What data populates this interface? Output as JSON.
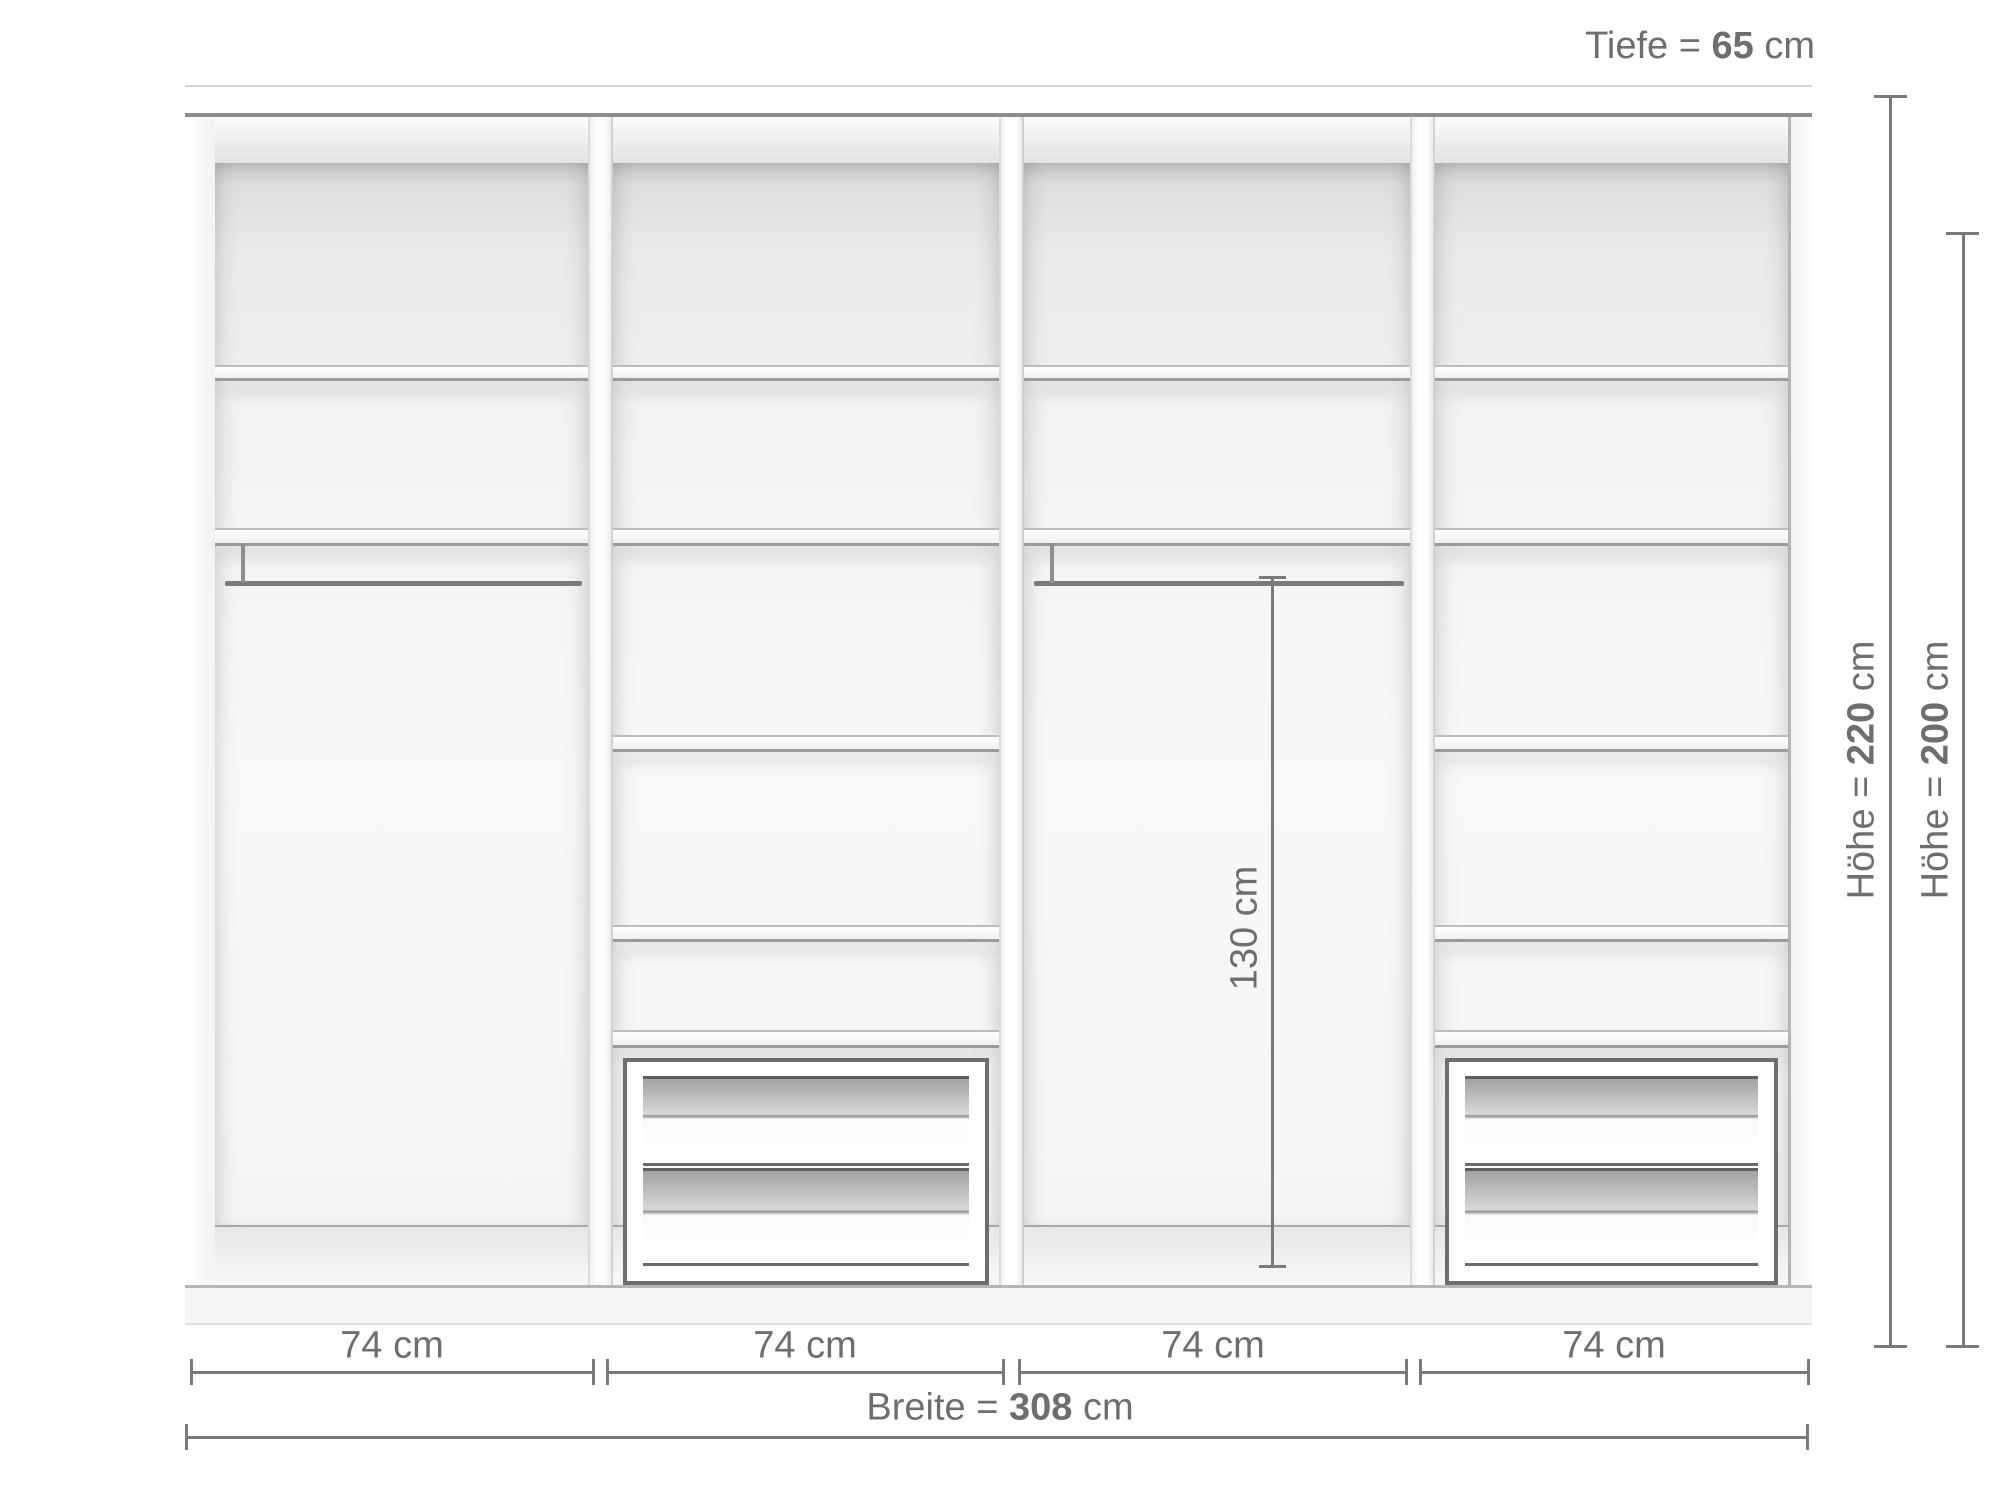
{
  "colors": {
    "dimension_text": "#6e6e6e",
    "dimension_line": "#7a7a7a"
  },
  "annotations": {
    "depth": {
      "prefix": "Tiefe = ",
      "value": "65",
      "unit": " cm"
    },
    "outer_height": {
      "prefix": "Höhe = ",
      "value": "220",
      "unit": " cm"
    },
    "inner_height": {
      "prefix": "Höhe = ",
      "value": "200",
      "unit": " cm"
    },
    "rail_height": "130 cm",
    "total_width": {
      "prefix": "Breite = ",
      "value": "308",
      "unit": " cm"
    }
  },
  "wardrobe": {
    "sections": [
      {
        "width_label": "74 cm",
        "shelves": 2,
        "clothes_rail": true,
        "drawers": 0
      },
      {
        "width_label": "74 cm",
        "shelves": 5,
        "clothes_rail": false,
        "drawers": 2
      },
      {
        "width_label": "74 cm",
        "shelves": 2,
        "clothes_rail": true,
        "drawers": 0
      },
      {
        "width_label": "74 cm",
        "shelves": 5,
        "clothes_rail": false,
        "drawers": 2
      }
    ]
  }
}
